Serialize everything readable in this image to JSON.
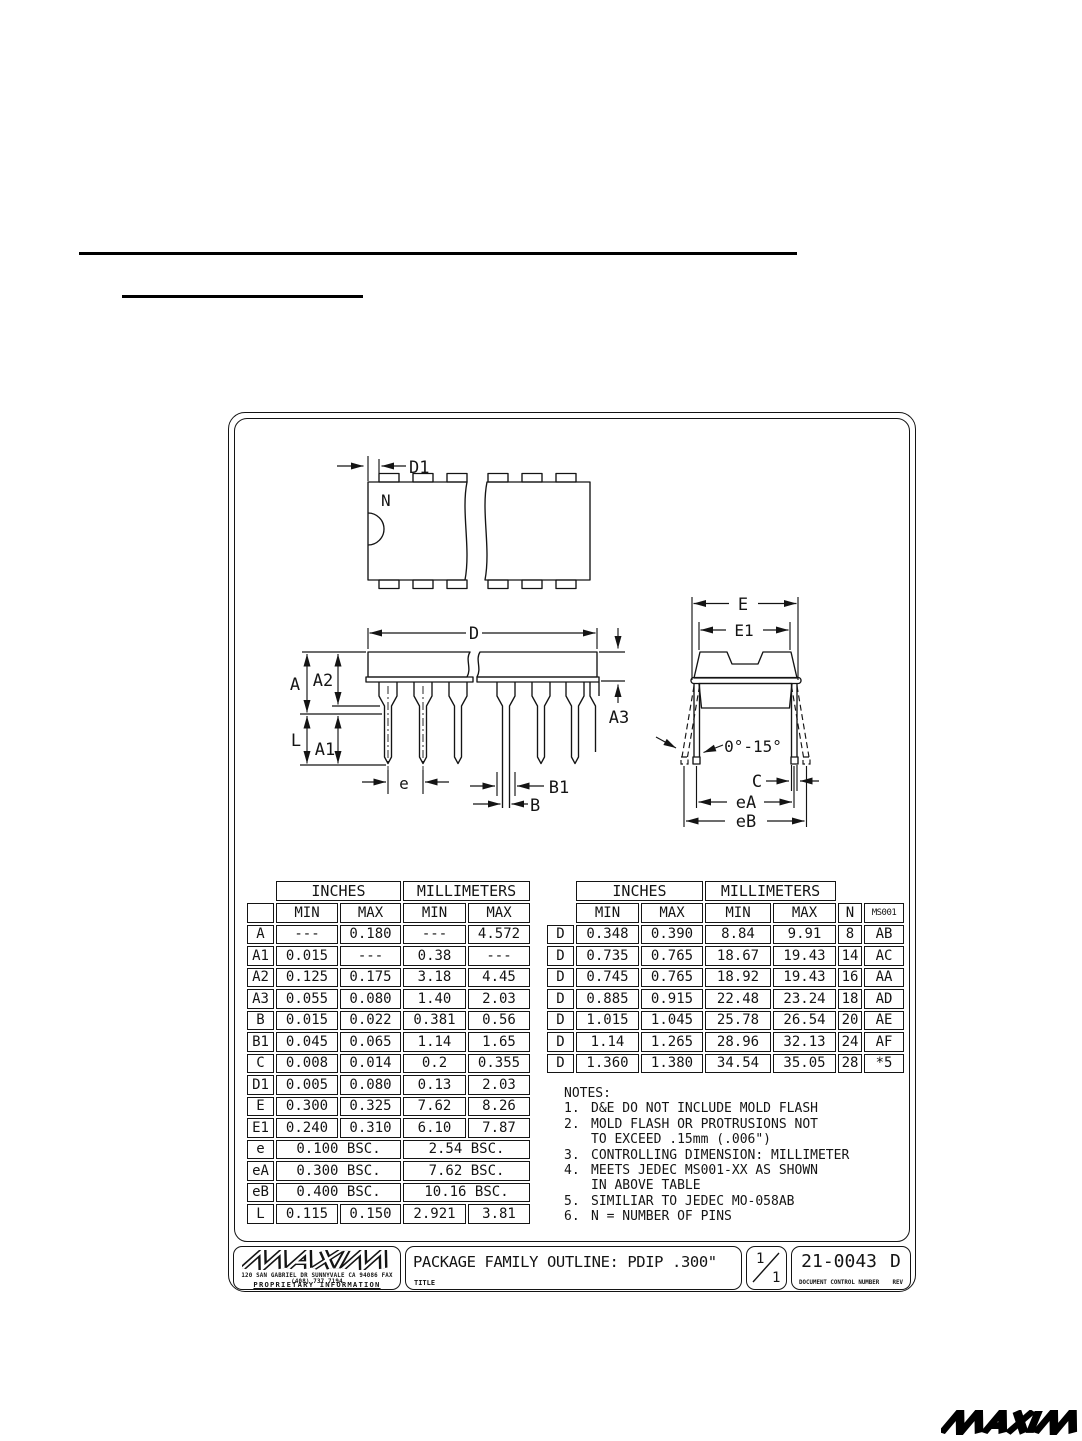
{
  "diagram": {
    "labels": {
      "n": "N",
      "d1": "D1",
      "d": "D",
      "a": "A",
      "a2": "A2",
      "a1": "A1",
      "l": "L",
      "a3": "A3",
      "e": "e",
      "b1": "B1",
      "b": "B",
      "E": "E",
      "e1": "E1",
      "angle": "0°-15°",
      "c": "C",
      "ea": "eA",
      "eb": "eB"
    }
  },
  "dimension_table": {
    "widths": [
      27,
      62,
      61,
      63,
      62
    ],
    "groups": [
      {
        "label": "INCHES",
        "span": 2
      },
      {
        "label": "MILLIMETERS",
        "span": 2
      }
    ],
    "extra_cols": 0,
    "corner_box": true,
    "sub": [
      "MIN",
      "MAX",
      "MIN",
      "MAX"
    ],
    "rows": [
      {
        "sym": "A",
        "cells": [
          "---",
          "0.180",
          "---",
          "4.572"
        ]
      },
      {
        "sym": "A1",
        "cells": [
          "0.015",
          "---",
          "0.38",
          "---"
        ]
      },
      {
        "sym": "A2",
        "cells": [
          "0.125",
          "0.175",
          "3.18",
          "4.45"
        ]
      },
      {
        "sym": "A3",
        "cells": [
          "0.055",
          "0.080",
          "1.40",
          "2.03"
        ]
      },
      {
        "sym": "B",
        "cells": [
          "0.015",
          "0.022",
          "0.381",
          "0.56"
        ]
      },
      {
        "sym": "B1",
        "cells": [
          "0.045",
          "0.065",
          "1.14",
          "1.65"
        ]
      },
      {
        "sym": "C",
        "cells": [
          "0.008",
          "0.014",
          "0.2",
          "0.355"
        ]
      },
      {
        "sym": "D1",
        "cells": [
          "0.005",
          "0.080",
          "0.13",
          "2.03"
        ]
      },
      {
        "sym": "E",
        "cells": [
          "0.300",
          "0.325",
          "7.62",
          "8.26"
        ]
      },
      {
        "sym": "E1",
        "cells": [
          "0.240",
          "0.310",
          "6.10",
          "7.87"
        ]
      },
      {
        "sym": "e",
        "cells": [
          "0.100  BSC.",
          "2.54  BSC."
        ]
      },
      {
        "sym": "eA",
        "cells": [
          "0.300  BSC.",
          "7.62  BSC."
        ]
      },
      {
        "sym": "eB",
        "cells": [
          "0.400  BSC.",
          "10.16  BSC."
        ]
      },
      {
        "sym": "L",
        "cells": [
          "0.115",
          "0.150",
          "2.921",
          "3.81"
        ]
      }
    ]
  },
  "d_table": {
    "widths": [
      27,
      63,
      62,
      66,
      63,
      24,
      40
    ],
    "groups": [
      {
        "label": "INCHES",
        "span": 2
      },
      {
        "label": "MILLIMETERS",
        "span": 2
      }
    ],
    "extra_cols": 2,
    "corner_box": false,
    "sub": [
      "MIN",
      "MAX",
      "MIN",
      "MAX",
      "N",
      "MS001"
    ],
    "rows": [
      {
        "sym": "D",
        "cells": [
          "0.348",
          "0.390",
          "8.84",
          "9.91",
          "8",
          "AB"
        ]
      },
      {
        "sym": "D",
        "cells": [
          "0.735",
          "0.765",
          "18.67",
          "19.43",
          "14",
          "AC"
        ]
      },
      {
        "sym": "D",
        "cells": [
          "0.745",
          "0.765",
          "18.92",
          "19.43",
          "16",
          "AA"
        ]
      },
      {
        "sym": "D",
        "cells": [
          "0.885",
          "0.915",
          "22.48",
          "23.24",
          "18",
          "AD"
        ]
      },
      {
        "sym": "D",
        "cells": [
          "1.015",
          "1.045",
          "25.78",
          "26.54",
          "20",
          "AE"
        ]
      },
      {
        "sym": "D",
        "cells": [
          "1.14",
          "1.265",
          "28.96",
          "32.13",
          "24",
          "AF"
        ]
      },
      {
        "sym": "D",
        "cells": [
          "1.360",
          "1.380",
          "34.54",
          "35.05",
          "28",
          "*5"
        ]
      }
    ]
  },
  "notes": {
    "heading": "NOTES:",
    "items": [
      {
        "num": "1.",
        "text": "D&E DO NOT INCLUDE MOLD FLASH"
      },
      {
        "num": "2.",
        "text": "MOLD FLASH OR PROTRUSIONS NOT\nTO EXCEED .15mm (.006\")"
      },
      {
        "num": "3.",
        "text": "CONTROLLING DIMENSION: MILLIMETER"
      },
      {
        "num": "4.",
        "text": "MEETS JEDEC MS001-XX AS SHOWN\nIN ABOVE TABLE"
      },
      {
        "num": "5.",
        "text": "SIMILIAR TO JEDEC MO-058AB"
      },
      {
        "num": "6.",
        "text": "N = NUMBER OF PINS"
      }
    ]
  },
  "title_block": {
    "logo_text": "MAXIM",
    "address": "120 SAN GABRIEL DR  SUNNYVALE CA 94086  FAX (408) 737 7194",
    "proprietary": "PROPRIETARY INFORMATION",
    "title": "PACKAGE FAMILY OUTLINE: PDIP .300\"",
    "title_label": "TITLE",
    "sheet_current": "1",
    "sheet_total": "1",
    "doc_number": "21-0043",
    "rev": "D",
    "doc_number_label": "DOCUMENT CONTROL NUMBER",
    "rev_label": "REV"
  },
  "footer": {
    "logo_text": "MAXIM"
  },
  "colors": {
    "ink": "#141414",
    "paper": "#ffffff"
  }
}
